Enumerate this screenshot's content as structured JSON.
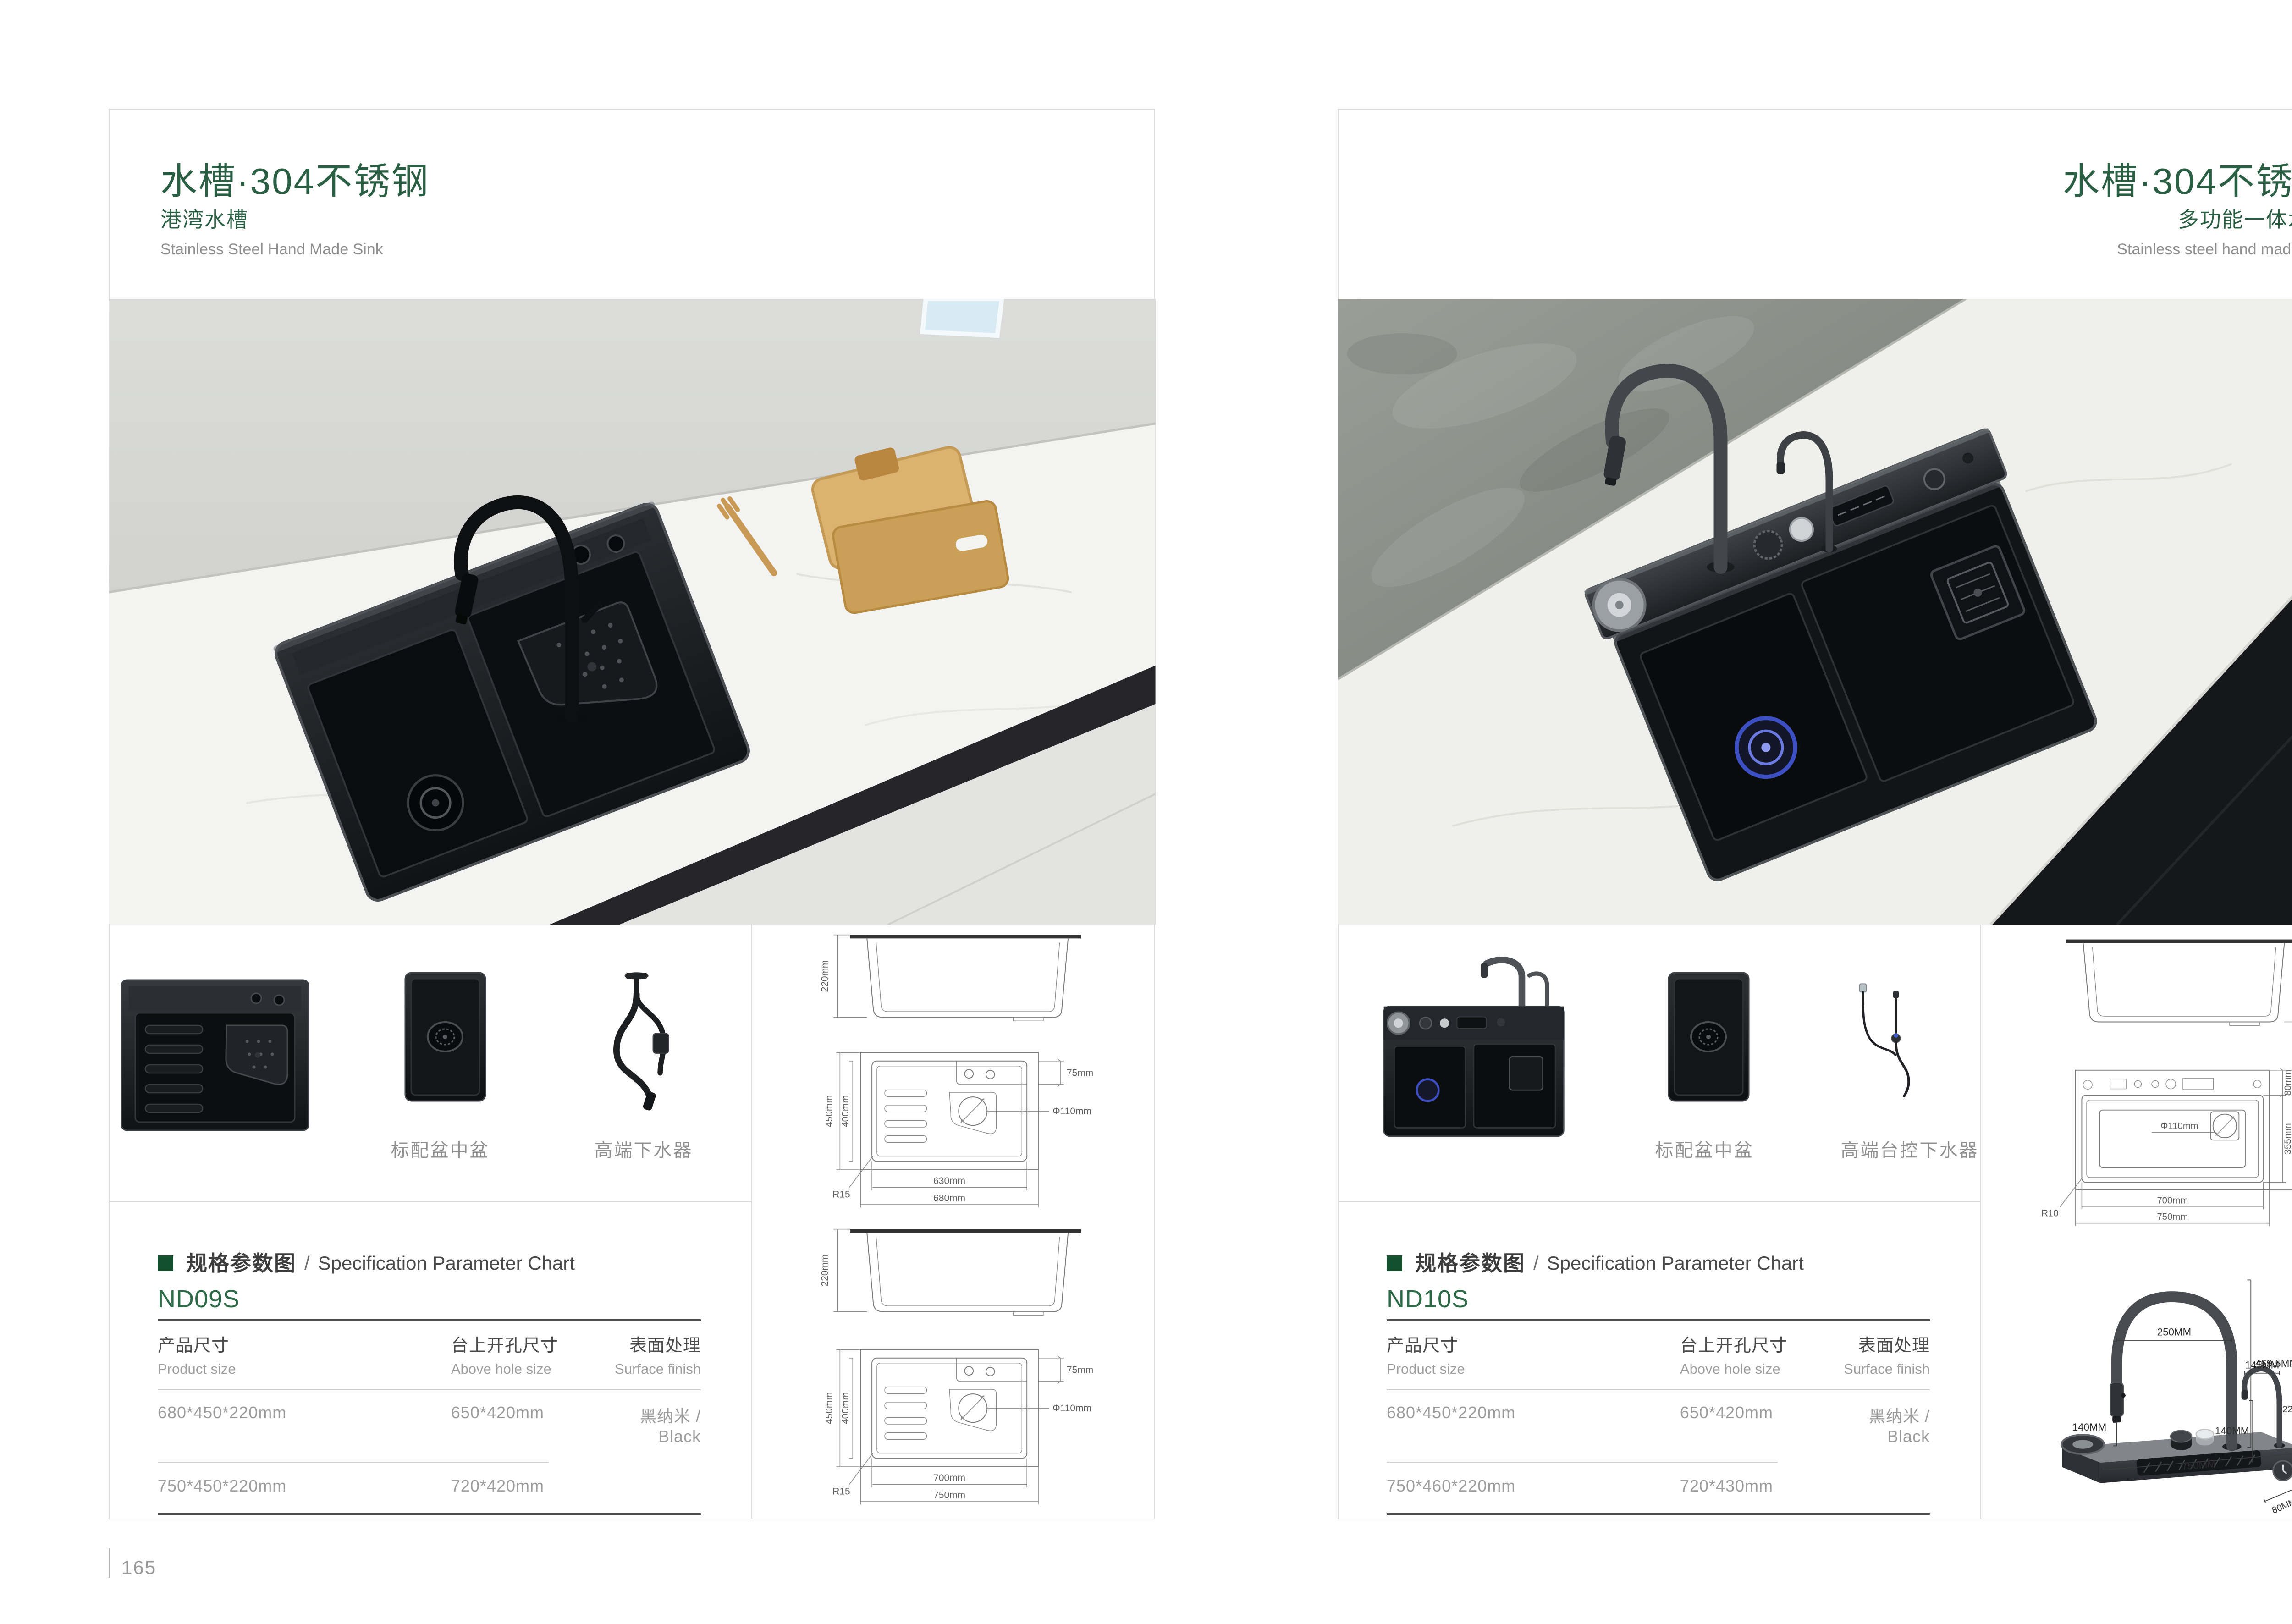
{
  "colors": {
    "accent_green": "#2b5f43",
    "model_green": "#2d6a47",
    "text_dark": "#474747",
    "text_gray": "#9a9a9a",
    "line_dark": "#4f4f4f",
    "line_light": "#cccccc",
    "card_border": "#dcdcdc"
  },
  "left": {
    "header": {
      "title": "水槽·304不锈钢",
      "subtitle": "港湾水槽",
      "subtitle_en": "Stainless Steel Hand Made Sink"
    },
    "thumbs": {
      "labels": [
        "标配盆中盆",
        "高端下水器"
      ]
    },
    "spec": {
      "section_cn": "规格参数图",
      "section_sep": "/",
      "section_en": "Specification Parameter Chart",
      "model": "ND09S",
      "columns": [
        {
          "cn": "产品尺寸",
          "en": "Product size"
        },
        {
          "cn": "台上开孔尺寸",
          "en": "Above hole size"
        },
        {
          "cn": "表面处理",
          "en": "Surface finish"
        }
      ],
      "rows": [
        [
          "680*450*220mm",
          "650*420mm",
          "黑纳米 / Black"
        ],
        [
          "750*450*220mm",
          "720*420mm",
          ""
        ]
      ]
    },
    "drawings": {
      "side_a": {
        "h": "220mm"
      },
      "top_a": {
        "outer_h": "450mm",
        "inner_h": "400mm",
        "deck": "75mm",
        "drain": "Φ110mm",
        "radius": "R15",
        "inner_w": "630mm",
        "outer_w": "680mm"
      },
      "side_b": {
        "h": "220mm"
      },
      "top_b": {
        "outer_h": "450mm",
        "inner_h": "400mm",
        "deck": "75mm",
        "drain": "Φ110mm",
        "radius": "R15",
        "inner_w": "700mm",
        "outer_w": "750mm"
      }
    },
    "folio": "165"
  },
  "right": {
    "header": {
      "title": "水槽·304不锈钢",
      "subtitle": "多功能一体水槽",
      "subtitle_en": "Stainless steel hand made sink"
    },
    "thumbs": {
      "labels": [
        "标配盆中盆",
        "高端台控下水器"
      ]
    },
    "spec": {
      "section_cn": "规格参数图",
      "section_sep": "/",
      "section_en": "Specification Parameter Chart",
      "model": "ND10S",
      "columns": [
        {
          "cn": "产品尺寸",
          "en": "Product size"
        },
        {
          "cn": "台上开孔尺寸",
          "en": "Above hole size"
        },
        {
          "cn": "表面处理",
          "en": "Surface finish"
        }
      ],
      "rows": [
        [
          "680*450*220mm",
          "650*420mm",
          "黑纳米 / Black"
        ],
        [
          "750*460*220mm",
          "720*430mm",
          ""
        ]
      ]
    },
    "drawings": {
      "side": {
        "h": "220mm"
      },
      "top": {
        "deck": "80mm",
        "basin": "355mm",
        "outer_h": "460mm",
        "drain": "Φ110mm",
        "radius": "R10",
        "inner_w": "700mm",
        "outer_w": "750mm"
      },
      "faucet": {
        "arc_big": "250MM",
        "total_h": "469.5MM",
        "drop_big": "140MM",
        "length": "750MM",
        "arc_small": "145MM",
        "drop_small": "140MM",
        "height_small": "225MM",
        "deck_h": "40MM",
        "deck_d": "80MM"
      }
    },
    "folio": "166"
  }
}
